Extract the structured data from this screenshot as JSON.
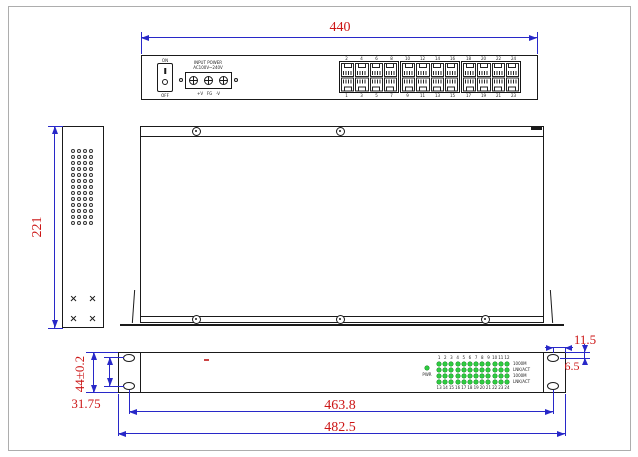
{
  "colors": {
    "dim_line": "#2828c8",
    "dim_text": "#cc1616",
    "outline": "#1a1a1a",
    "led_green": "#2ecc40"
  },
  "rear_view": {
    "dim_width": "440",
    "power_switch": {
      "on_label": "ON",
      "off_label": "OFF"
    },
    "power_input": {
      "line1": "INPUT POWER",
      "line2": "AC100V~240V",
      "terminal_labels": "+V   FG   -V"
    },
    "port_groups": [
      {
        "top": [
          "2",
          "4",
          "6",
          "8"
        ],
        "bottom": [
          "1",
          "3",
          "5",
          "7"
        ]
      },
      {
        "top": [
          "10",
          "12",
          "14",
          "16"
        ],
        "bottom": [
          "9",
          "11",
          "13",
          "15"
        ]
      },
      {
        "top": [
          "18",
          "20",
          "22",
          "24"
        ],
        "bottom": [
          "17",
          "19",
          "21",
          "23"
        ]
      }
    ]
  },
  "side_view": {
    "dim_height": "221"
  },
  "front_view": {
    "dims": {
      "panel_height": "44±0.2",
      "hole_spacing": "31.75",
      "hole_centers_width": "463.8",
      "full_width": "482.5",
      "ear_width": "11.5",
      "hole_top_offset": "6.5"
    },
    "leds": {
      "pwr_label": "PWR",
      "top_numbers": [
        "1",
        "2",
        "3",
        "4",
        "5",
        "6",
        "7",
        "8",
        "9",
        "10",
        "11",
        "12"
      ],
      "bottom_numbers": [
        "13",
        "14",
        "15",
        "16",
        "17",
        "18",
        "19",
        "20",
        "21",
        "22",
        "23",
        "24"
      ],
      "row_labels": [
        "1000M",
        "LNK/ACT",
        "1000M",
        "LNK/ACT"
      ]
    }
  }
}
